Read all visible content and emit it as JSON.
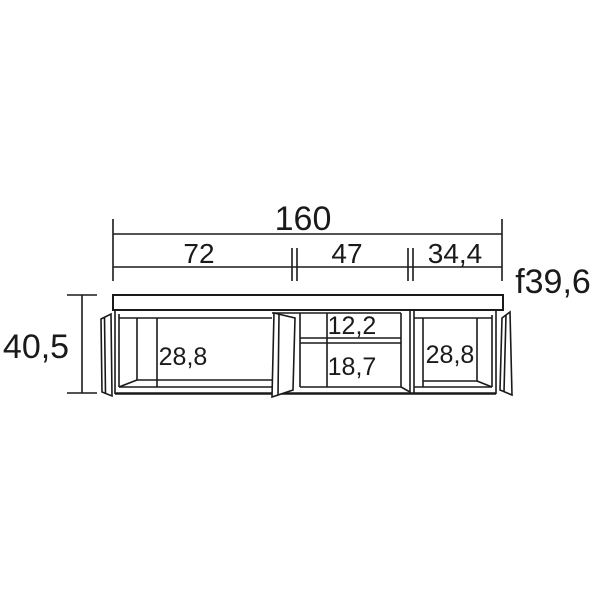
{
  "drawing": {
    "subject": "tv-stand-technical-dimension-drawing",
    "background": "#ffffff",
    "line_color": "#1a1a1a"
  },
  "dimensions": {
    "total_width": "160",
    "section_widths": [
      "72",
      "47",
      "34,4"
    ],
    "depth": "f39,6",
    "height": "40,5",
    "interior": {
      "left_compartment": "28,8",
      "middle_shelf_top": "12,2",
      "middle_shelf_bottom": "18,7",
      "right_compartment": "28,8"
    }
  }
}
